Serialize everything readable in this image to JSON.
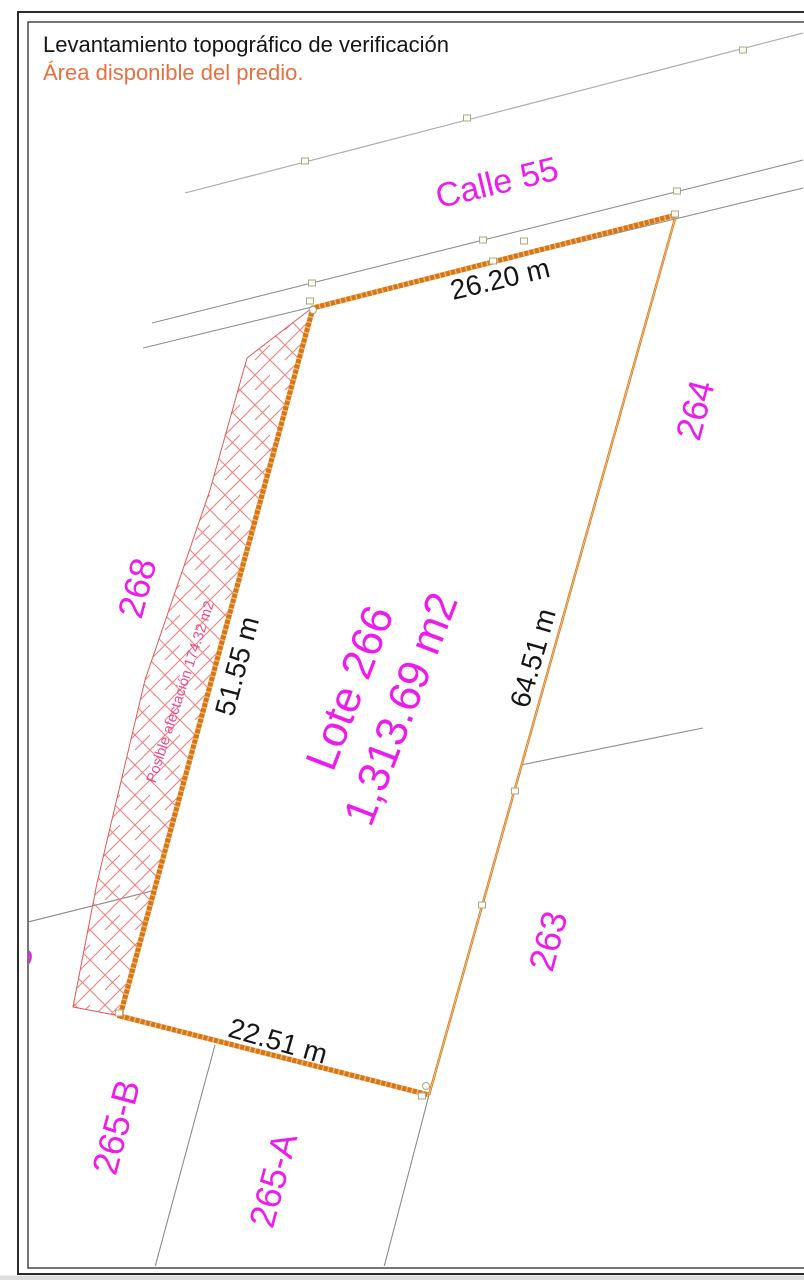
{
  "page": {
    "title": "Levantamiento topográfico de verificación",
    "subtitle": "Área disponible del predio."
  },
  "street": {
    "label": "Calle 55"
  },
  "lot": {
    "label": "Lote 266",
    "area": "1,313.69 m2"
  },
  "dimensions": {
    "top": "26.20 m",
    "right": "64.51 m",
    "bottom": "22.51 m",
    "left": "51.55 m"
  },
  "affectation": {
    "label": "Posible afectación 174.32 m2"
  },
  "neighbors": {
    "nw": "268",
    "ne": "264",
    "se": "263",
    "sw_b": "265-B",
    "sw_a": "265-A",
    "partial": "265"
  },
  "colors": {
    "magenta": "#ed1ced",
    "pink_label": "#ea4a8c",
    "orange_line": "#d9760f",
    "orange_text": "#e7703f",
    "hatch_red": "#f08080",
    "hatch_outline": "#e05858",
    "gray_line": "#9c9c9c",
    "black_text": "#161616",
    "marker_fill": "#fbfbf2",
    "marker_stroke": "#a8a88a"
  }
}
